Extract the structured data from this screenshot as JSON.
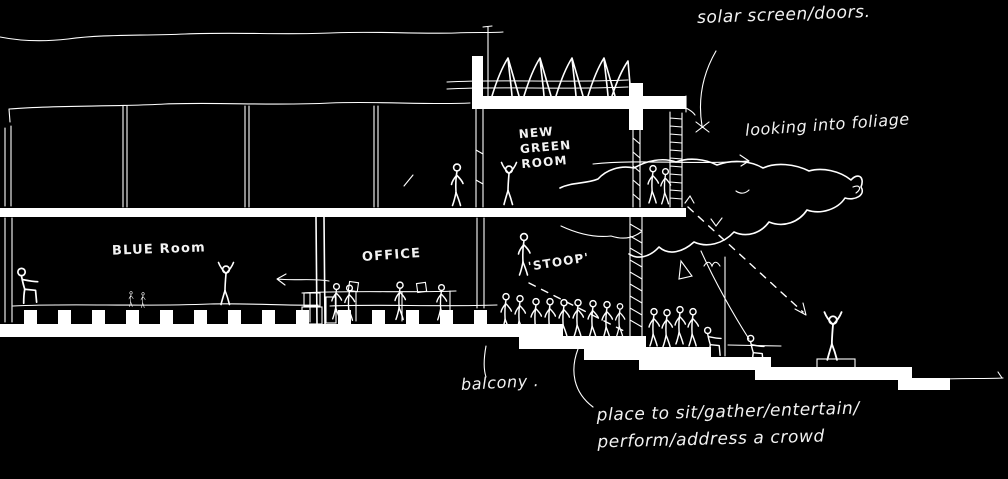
{
  "canvas": {
    "background": "#000000",
    "ink": "#ffffff",
    "description": "hand-drawn architectural building section sketch, white ink on black"
  },
  "sketch": {
    "annotations": {
      "solar_screen": "solar screen/doors.",
      "looking_into_foliage": "looking into foliage",
      "new_green_room": "NEW\nGREEN\nROOM",
      "blue_room": "BLUE Room",
      "office": "OFFICE",
      "stoop": "'STOOP'",
      "balcony": "balcony .",
      "place_to_sit": "place to sit/gather/entertain/\nperform/address a crowd"
    }
  }
}
